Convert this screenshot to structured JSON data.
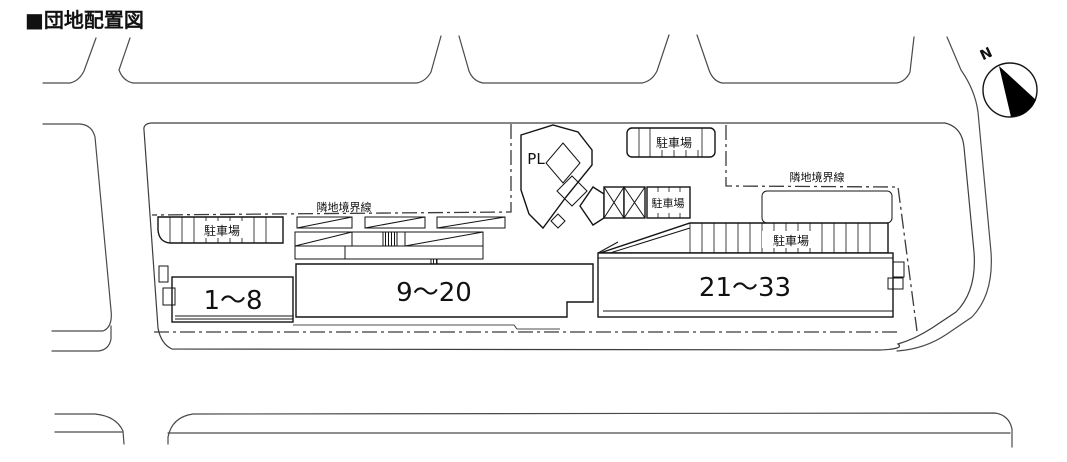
{
  "title": "■団地配置図",
  "compass": {
    "north": "N"
  },
  "boundaries": {
    "west_label": "隣地境界線",
    "east_label": "隣地境界線"
  },
  "parking": {
    "left": "駐車場",
    "top": "駐車場",
    "middle": "駐車場",
    "right": "駐車場"
  },
  "playground": {
    "label": "PL"
  },
  "buildings": [
    {
      "id": "1-8",
      "label": "1～8"
    },
    {
      "id": "9-20",
      "label": "9～20"
    },
    {
      "id": "21-33",
      "label": "21～33"
    }
  ]
}
